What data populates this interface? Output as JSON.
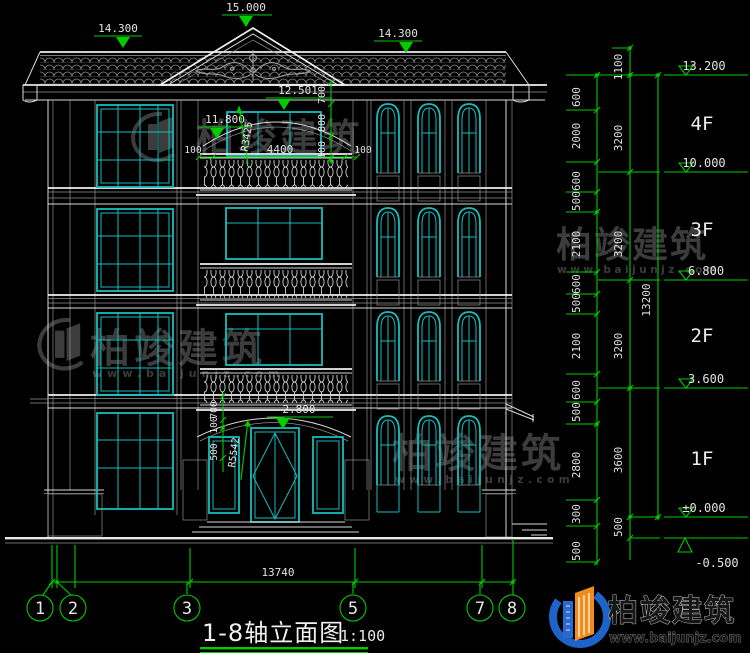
{
  "colors": {
    "background": "#000000",
    "dimension_green": "#00cc00",
    "text_white": "#e2e2e2",
    "line_white": "#d9d9d9",
    "window_cyan": "#17bdbd",
    "watermark_gray": "#3c3c3c",
    "logo_blue": "#1e63c8",
    "logo_orange": "#ef8c1c"
  },
  "top_markers": {
    "ridge": "15.000",
    "eave_left": "14.300",
    "eave_right": "14.300"
  },
  "facade": {
    "arc_top_elev": "12.501",
    "chain_4f": [
      "700",
      "800",
      "100"
    ],
    "balcony_elev": "11.800",
    "arc_radius": "R3425",
    "balcony_width": "4400",
    "offset_left": "100",
    "offset_right": "100",
    "entry_elev": "2.800",
    "entry_radius": "R5542",
    "entry_chain": [
      "700",
      "100",
      "500"
    ]
  },
  "right_panel": {
    "floors": [
      "4F",
      "3F",
      "2F",
      "1F"
    ],
    "elevations": [
      "13.200",
      "10.000",
      "6.800",
      "3.600",
      "±0.000",
      "-0.500"
    ],
    "detail_chain": [
      "600",
      "2000",
      "600",
      "500",
      "2100",
      "600",
      "500",
      "2100",
      "600",
      "500",
      "2800",
      "300",
      "500"
    ],
    "floor_chain": [
      "1100",
      "3200",
      "3200",
      "3200",
      "3600",
      "500"
    ],
    "overall_height": "13200"
  },
  "bottom": {
    "overall_width": "13740",
    "axis_bubbles": [
      "1",
      "2",
      "3",
      "5",
      "7",
      "8"
    ],
    "title": "1-8轴立面图",
    "scale": "1:100"
  },
  "watermark": {
    "name_cn": "柏竣建筑",
    "url": "www.baijunjz.com"
  },
  "logo": {
    "name_cn": "柏竣建筑",
    "url": "www.baijunjz.com"
  }
}
